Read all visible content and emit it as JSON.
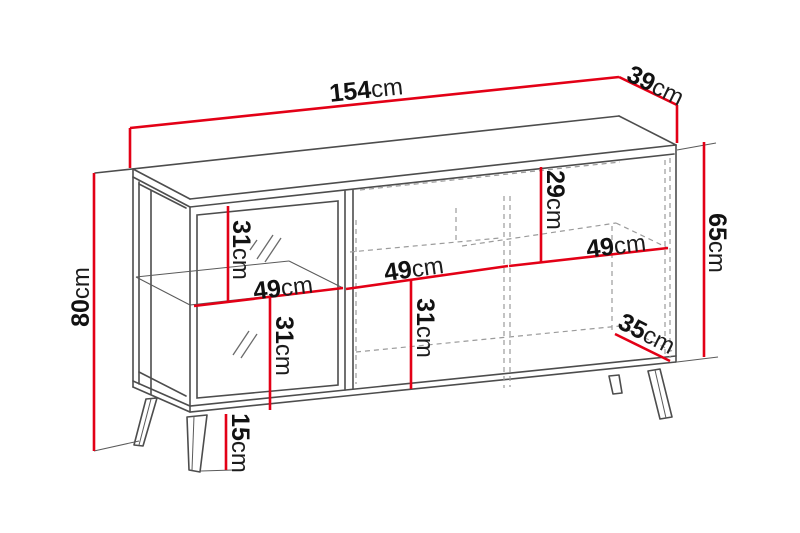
{
  "diagram": {
    "type": "furniture-dimension-drawing",
    "unit": "cm",
    "colors": {
      "dimension_red": "#e30016",
      "outline_gray": "#4d4d4d",
      "hidden_edge_gray": "#9b9b9b",
      "label_black": "#121212",
      "background": "#ffffff"
    },
    "dimensions": [
      {
        "id": "total-width",
        "value": "154",
        "unit": "cm"
      },
      {
        "id": "total-depth",
        "value": "39",
        "unit": "cm"
      },
      {
        "id": "total-height",
        "value": "80",
        "unit": "cm"
      },
      {
        "id": "body-height",
        "value": "65",
        "unit": "cm"
      },
      {
        "id": "left-top-section-height",
        "value": "31",
        "unit": "cm"
      },
      {
        "id": "left-shelf-width",
        "value": "49",
        "unit": "cm"
      },
      {
        "id": "left-bottom-section-height",
        "value": "31",
        "unit": "cm"
      },
      {
        "id": "middle-shelf-width",
        "value": "49",
        "unit": "cm"
      },
      {
        "id": "middle-bottom-section-height",
        "value": "31",
        "unit": "cm"
      },
      {
        "id": "right-top-section-height",
        "value": "29",
        "unit": "cm"
      },
      {
        "id": "right-shelf-width",
        "value": "49",
        "unit": "cm"
      },
      {
        "id": "interior-depth",
        "value": "35",
        "unit": "cm"
      },
      {
        "id": "leg-height",
        "value": "15",
        "unit": "cm"
      }
    ]
  }
}
